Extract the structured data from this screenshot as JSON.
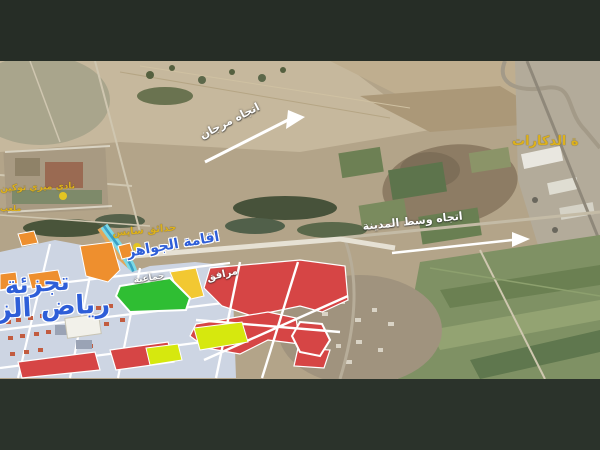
{
  "scene_title": "satellite-subdivision-map",
  "letterbox": {
    "top_color": "#262d26",
    "bottom_color": "#2b332b"
  },
  "labels": {
    "marjane_direction": "اتجاه مرجان",
    "dkarat_area": "ة الدكارات",
    "city_center_direction": "اتجاه وسط المدينة",
    "club": "نادي ميري توكين",
    "club_small": "ملعب",
    "gardens": "حدائق سايس",
    "residence": "اقامة الجواهر",
    "subdivision_title_line1": "تجزئة",
    "subdivision_title_line2": "رياض الز",
    "facilities": "مرافق",
    "communal": "جماعية"
  },
  "zones": {
    "red": "#d64545",
    "orange": "#ee8f2e",
    "green": "#2fbe33",
    "chartreuse": "#d6e80e",
    "yellow": "#f2c832",
    "canal": "#7cd9e6",
    "plan_base": "#cdd5e3"
  },
  "label_colors": {
    "yellow_text": "#ddb11c",
    "blue_text": "#2e5ed8",
    "white_text": "#ffffff"
  }
}
